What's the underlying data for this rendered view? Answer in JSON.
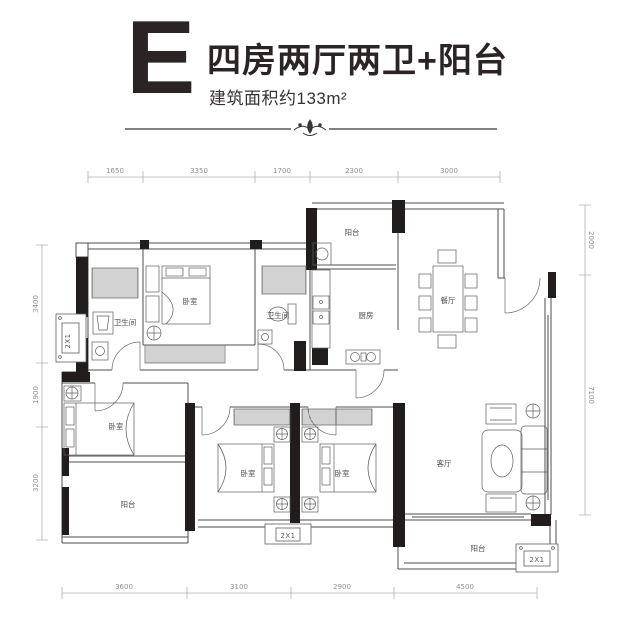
{
  "header": {
    "unit_letter": "E",
    "title": "四房两厅两卫+阳台",
    "subtitle": "建筑面积约133m²"
  },
  "plan": {
    "ac_label": "2X1",
    "rooms": {
      "balcony_top": "阳台",
      "kitchen": "厨房",
      "dining": "餐厅",
      "bath_left": "卫生间",
      "bedroom_top": "卧室",
      "bath_mid": "卫生间",
      "bedroom_left": "卧室",
      "balcony_left": "阳台",
      "bedroom_c1": "卧室",
      "bedroom_c2": "卧室",
      "living": "客厅",
      "balcony_right": "阳台"
    },
    "dims_top": [
      "1650",
      "3350",
      "1700",
      "2300",
      "3000"
    ],
    "dims_bottom": [
      "3600",
      "3100",
      "2900",
      "4500"
    ],
    "dims_left": [
      "3400",
      "1900",
      "3200"
    ],
    "dims_right": [
      "2000",
      "7100"
    ]
  }
}
